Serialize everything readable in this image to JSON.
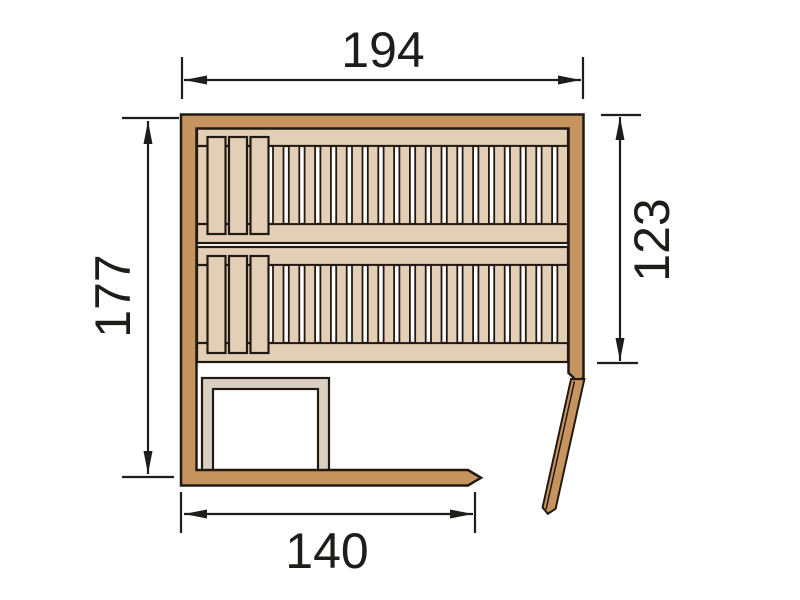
{
  "figure": {
    "type": "technical-drawing",
    "subject": "sauna floor plan with dimensions"
  },
  "dimensions": {
    "top": {
      "value": "194"
    },
    "left": {
      "value": "177"
    },
    "right": {
      "value": "123"
    },
    "bottom": {
      "value": "140"
    }
  },
  "benches": {
    "modules": [
      {
        "top": 128
      },
      {
        "top": 247
      }
    ],
    "narrow_slat_count": 19,
    "wide_slat_count": 3,
    "wide_slat_x": [
      207.5,
      229,
      250.5
    ]
  },
  "colors": {
    "wall": "#c6945e",
    "wood": "#e3cfb5",
    "frame_strip": "#d9d0c3",
    "outline": "#231913",
    "dimension": "#1d1d1b",
    "background": "#ffffff"
  }
}
